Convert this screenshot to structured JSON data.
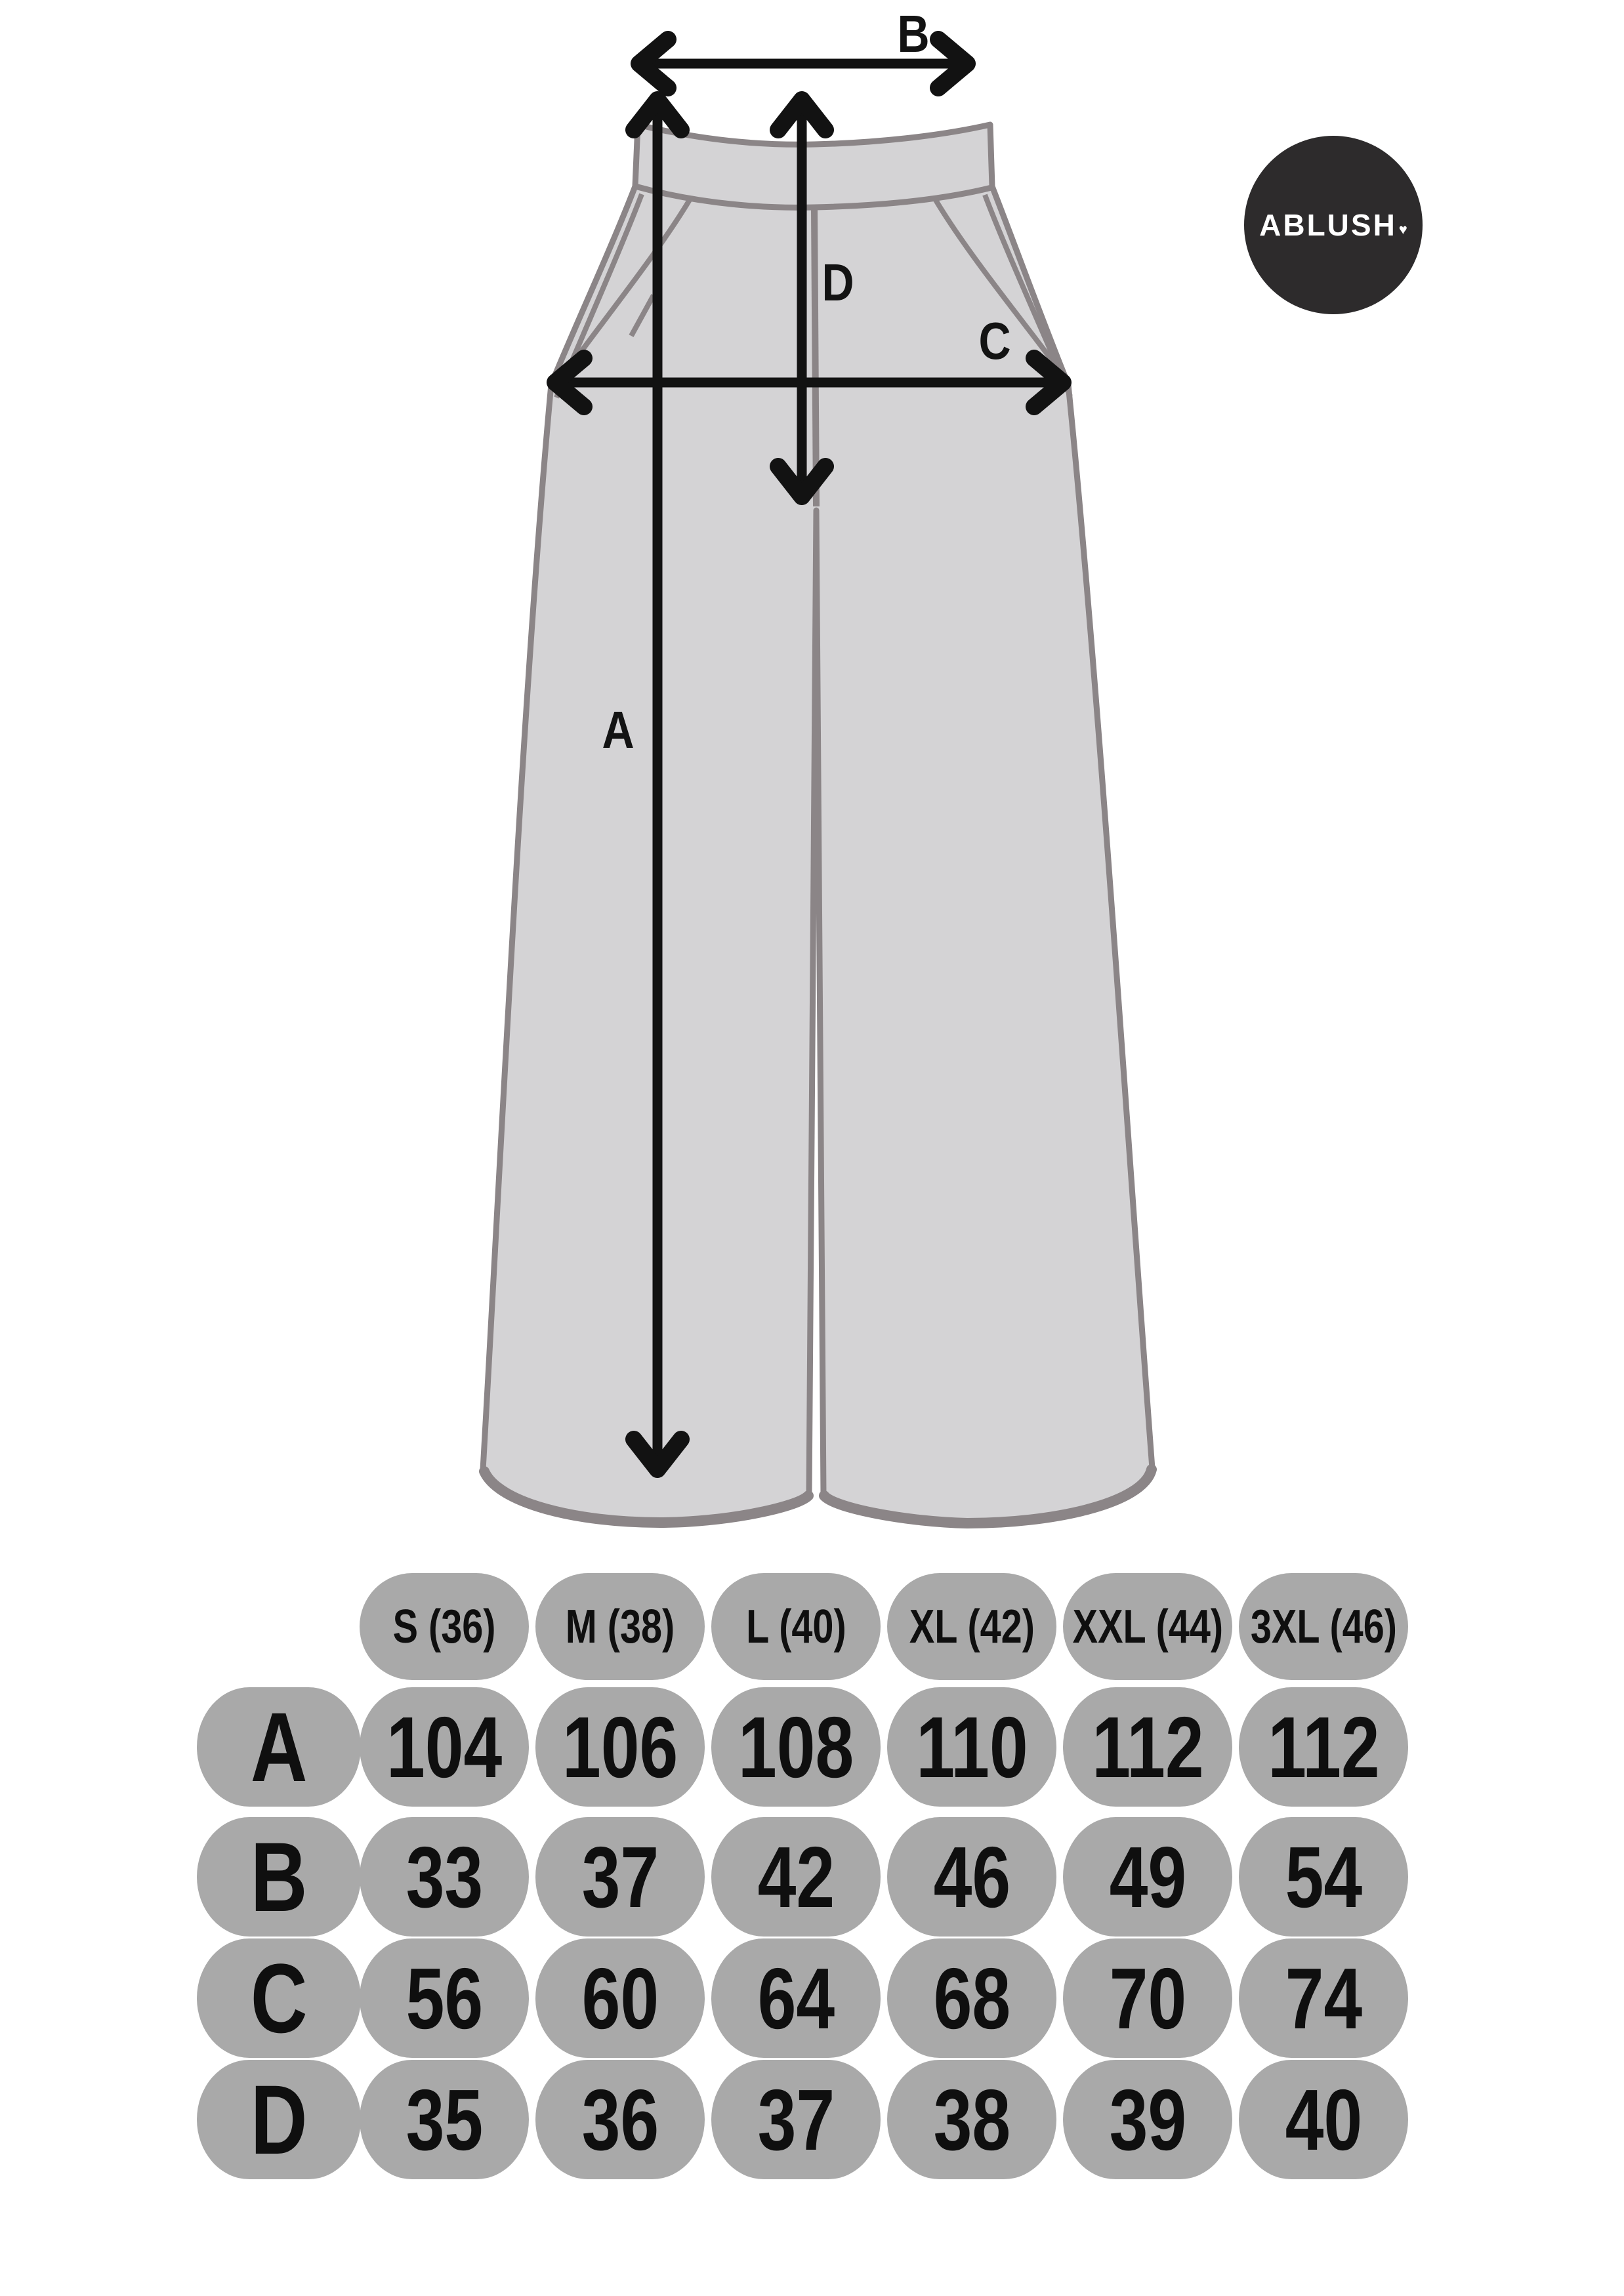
{
  "brand": {
    "name": "ABLUSH",
    "heart": "♥"
  },
  "diagram": {
    "labels": {
      "a": "A",
      "b": "B",
      "c": "C",
      "d": "D"
    }
  },
  "size_table": {
    "header": [
      "S (36)",
      "M (38)",
      "L (40)",
      "XL (42)",
      "XXL (44)",
      "3XL (46)"
    ],
    "rows": [
      {
        "label": "A",
        "values": [
          "104",
          "106",
          "108",
          "110",
          "112",
          "112"
        ]
      },
      {
        "label": "B",
        "values": [
          "33",
          "37",
          "42",
          "46",
          "49",
          "54"
        ]
      },
      {
        "label": "C",
        "values": [
          "56",
          "60",
          "64",
          "68",
          "70",
          "74"
        ]
      },
      {
        "label": "D",
        "values": [
          "35",
          "36",
          "37",
          "38",
          "39",
          "40"
        ]
      }
    ]
  },
  "chart_data": {
    "type": "table",
    "columns": [
      "S (36)",
      "M (38)",
      "L (40)",
      "XL (42)",
      "XXL (44)",
      "3XL (46)"
    ],
    "rows": [
      {
        "measure": "A",
        "values": [
          104,
          106,
          108,
          110,
          112,
          112
        ]
      },
      {
        "measure": "B",
        "values": [
          33,
          37,
          42,
          46,
          49,
          54
        ]
      },
      {
        "measure": "C",
        "values": [
          56,
          60,
          64,
          68,
          70,
          74
        ]
      },
      {
        "measure": "D",
        "values": [
          35,
          36,
          37,
          38,
          39,
          40
        ]
      }
    ]
  },
  "colors": {
    "pants_fill": "#d4d3d5",
    "pants_outline": "#8b8587",
    "pill_gray": "#a9a9a9",
    "ink": "#111111",
    "logo_circle": "#2d2b2c"
  }
}
